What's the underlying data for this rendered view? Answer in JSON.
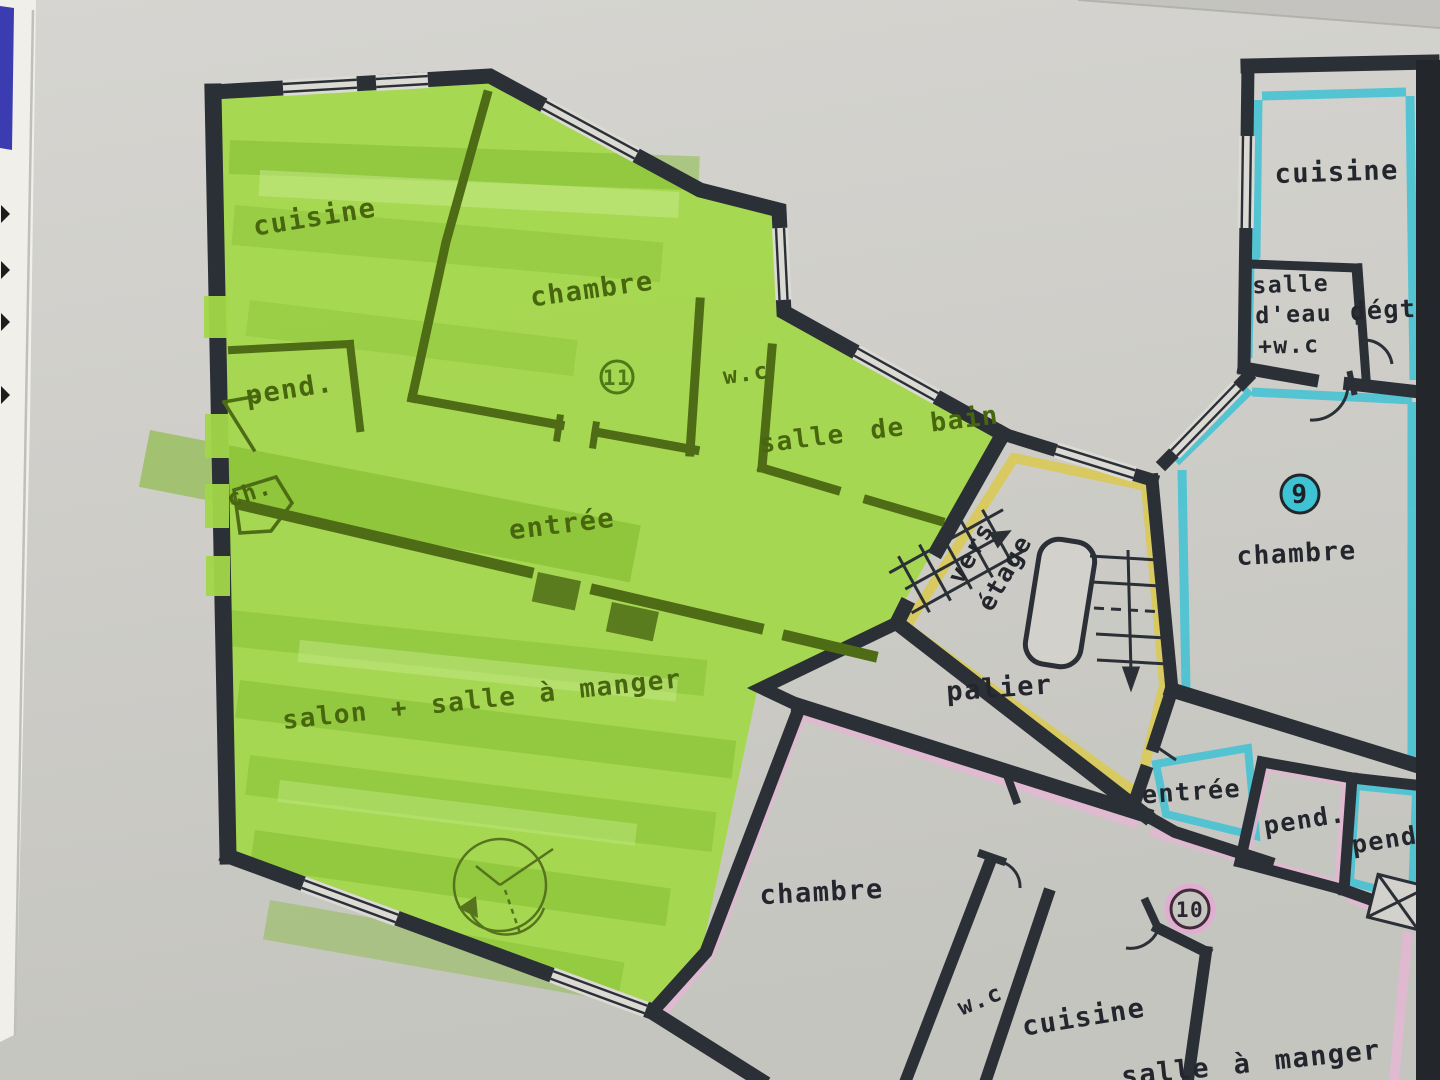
{
  "plan": {
    "units": {
      "unit11": {
        "number": "11",
        "highlight_color": "#a3d848",
        "rooms": {
          "cuisine": "cuisine",
          "chambre": "chambre",
          "wc": "w.c",
          "salle_de_bain": "salle de bain",
          "pend": "pend.",
          "ch": "ch.",
          "entree": "entrée",
          "salon": "salon + salle à manger"
        }
      },
      "unit9": {
        "number": "9",
        "highlight_color": "#3fc2d4",
        "rooms": {
          "cuisine": "cuisine",
          "salle_deau_line1": "salle",
          "salle_deau_line2": "d'eau",
          "salle_deau_line3": "+w.c",
          "degt": "dégt.",
          "chambre": "chambre",
          "entree": "entrée",
          "pend": "pend."
        }
      },
      "unit10": {
        "number": "10",
        "highlight_color": "#e3b7d3",
        "rooms": {
          "chambre": "chambre",
          "wc": "w.c",
          "cuisine": "cuisine",
          "salle_a_manger": "salle à manger",
          "pend": "pend."
        }
      }
    },
    "common": {
      "palier": "palier",
      "stairs": {
        "line1": "vers",
        "line2": "étage"
      }
    },
    "colors": {
      "wall": "#2b3036",
      "paper": "#d2d1cc",
      "photo_background": "#cbcbc6",
      "palier_highlight": "#d9ca55"
    }
  }
}
